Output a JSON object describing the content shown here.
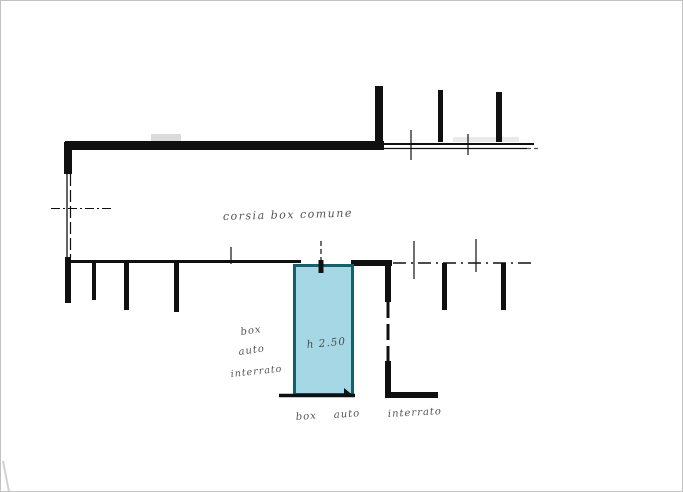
{
  "canvas": {
    "width": 683,
    "height": 492,
    "background": "#ffffff",
    "frame_color": "#c2c2c2"
  },
  "palette": {
    "ink": "#101010",
    "pencil": "#3b3b3b",
    "highlight_fill": "#a6d7e4",
    "highlight_stroke": "#175f6d",
    "smudge": "#b8b8b8",
    "page_edge": "#cccccc"
  },
  "annotations": {
    "lane_label": {
      "name": "lane-label",
      "text": "corsia box comune",
      "x": 222,
      "y": 219,
      "size": 11,
      "rotate": -1.5,
      "spacing": 1.5
    },
    "unit_label": {
      "name": "highlighted-unit-label",
      "text": "h 2.50",
      "x": 306,
      "y": 347,
      "size": 10.5,
      "rotate": -5
    },
    "side_note": {
      "lines": [
        {
          "name": "side-note-line-1",
          "text": "box",
          "x": 240,
          "y": 334,
          "size": 10,
          "rotate": -8
        },
        {
          "name": "side-note-line-2",
          "text": "auto",
          "x": 238,
          "y": 354,
          "size": 10,
          "rotate": -8
        },
        {
          "name": "side-note-line-3",
          "text": "interrato",
          "x": 230,
          "y": 376,
          "size": 9.5,
          "rotate": -6
        }
      ]
    },
    "bottom_note": {
      "words": [
        {
          "name": "bottom-note-word-1",
          "text": "box",
          "x": 295,
          "y": 419,
          "size": 10,
          "rotate": -4
        },
        {
          "name": "bottom-note-word-2",
          "text": "auto",
          "x": 333,
          "y": 417,
          "size": 10,
          "rotate": -4
        },
        {
          "name": "bottom-note-word-3",
          "text": "interrato",
          "x": 387,
          "y": 416,
          "size": 10,
          "rotate": -3
        }
      ]
    }
  },
  "drawing": {
    "elements": [
      {
        "k": "rect",
        "n": "scan-smudge",
        "x": 150,
        "y": 133,
        "w": 30,
        "h": 7,
        "fill": "smudge",
        "o": 0.5
      },
      {
        "k": "rect",
        "n": "scan-smudge",
        "x": 452,
        "y": 136,
        "w": 66,
        "h": 5,
        "fill": "smudge",
        "o": 0.3
      },
      {
        "k": "line",
        "n": "page-edge-mark",
        "x1": 2,
        "y1": 460,
        "x2": 8,
        "y2": 491,
        "stroke": "page_edge",
        "sw": 2,
        "o": 0.9
      },
      {
        "k": "rect",
        "n": "top-wall",
        "x": 64,
        "y": 140,
        "w": 319,
        "h": 9
      },
      {
        "k": "line",
        "n": "top-wall-extension-upper",
        "x1": 383,
        "y1": 143,
        "x2": 533,
        "y2": 143,
        "sw": 2
      },
      {
        "k": "line",
        "n": "top-wall-extension-lower",
        "x1": 383,
        "y1": 147.5,
        "x2": 526,
        "y2": 147.5,
        "sw": 1.2
      },
      {
        "k": "line",
        "n": "top-wall-extension-dash",
        "x1": 526,
        "y1": 147.5,
        "x2": 538,
        "y2": 147.5,
        "sw": 1.2,
        "dash": "4 3",
        "o": 0.7
      },
      {
        "k": "rect",
        "n": "upper-divider-tick",
        "x": 374,
        "y": 85,
        "w": 8,
        "h": 56
      },
      {
        "k": "rect",
        "n": "upper-divider-tick",
        "x": 437,
        "y": 89,
        "w": 5,
        "h": 52
      },
      {
        "k": "rect",
        "n": "upper-divider-tick",
        "x": 495,
        "y": 91,
        "w": 6,
        "h": 50
      },
      {
        "k": "line",
        "n": "survey-cross",
        "x1": 410,
        "y1": 129,
        "x2": 410,
        "y2": 159,
        "sw": 1.2
      },
      {
        "k": "line",
        "n": "survey-cross",
        "x1": 467,
        "y1": 133,
        "x2": 467,
        "y2": 154,
        "sw": 1.2
      },
      {
        "k": "rect",
        "n": "left-wall-corner",
        "x": 63,
        "y": 141,
        "w": 8,
        "h": 32
      },
      {
        "k": "line",
        "n": "left-wall-inner",
        "x1": 66,
        "y1": 173,
        "x2": 66,
        "y2": 259,
        "sw": 1.3
      },
      {
        "k": "line",
        "n": "left-wall-outer",
        "x1": 69.5,
        "y1": 173,
        "x2": 69.5,
        "y2": 257,
        "sw": 1.2,
        "dash": "12 4"
      },
      {
        "k": "rect",
        "n": "left-wall-lower",
        "x": 64,
        "y": 256,
        "w": 6,
        "h": 46
      },
      {
        "k": "line",
        "n": "centerline-cross",
        "x1": 50,
        "y1": 207.5,
        "x2": 110,
        "y2": 207.5,
        "sw": 1,
        "dash": "9 3 2 3"
      },
      {
        "k": "line",
        "n": "lower-wall-left",
        "x1": 64,
        "y1": 260.5,
        "x2": 300,
        "y2": 260.5,
        "sw": 3
      },
      {
        "k": "rect",
        "n": "lower-wall-mid",
        "x": 350,
        "y": 259,
        "w": 41,
        "h": 6
      },
      {
        "k": "line",
        "n": "lower-wall-dashdot",
        "x1": 392,
        "y1": 262,
        "x2": 533,
        "y2": 262,
        "sw": 1.5,
        "dash": "13 5 2 5"
      },
      {
        "k": "rect",
        "n": "lower-divider-tick",
        "x": 91,
        "y": 262,
        "w": 4,
        "h": 37
      },
      {
        "k": "rect",
        "n": "lower-divider-tick",
        "x": 123,
        "y": 262,
        "w": 5,
        "h": 47
      },
      {
        "k": "rect",
        "n": "lower-divider-tick",
        "x": 173,
        "y": 262,
        "w": 5,
        "h": 49
      },
      {
        "k": "rect",
        "n": "lower-divider-tick",
        "x": 441,
        "y": 262,
        "w": 5,
        "h": 47
      },
      {
        "k": "rect",
        "n": "lower-divider-tick",
        "x": 500,
        "y": 262,
        "w": 5,
        "h": 47
      },
      {
        "k": "line",
        "n": "survey-cross",
        "x1": 230,
        "y1": 246,
        "x2": 230,
        "y2": 263,
        "sw": 1.2
      },
      {
        "k": "line",
        "n": "survey-cross",
        "x1": 413,
        "y1": 240,
        "x2": 413,
        "y2": 278,
        "sw": 1.2
      },
      {
        "k": "line",
        "n": "survey-cross",
        "x1": 475,
        "y1": 238,
        "x2": 475,
        "y2": 271,
        "sw": 1.2
      },
      {
        "k": "rect",
        "n": "right-wall-upper",
        "x": 384,
        "y": 261,
        "w": 6,
        "h": 40
      },
      {
        "k": "line",
        "n": "right-wall-middle",
        "x1": 387,
        "y1": 301,
        "x2": 387,
        "y2": 362,
        "sw": 3,
        "dash": "16 6"
      },
      {
        "k": "rect",
        "n": "right-wall-lower",
        "x": 384,
        "y": 360,
        "w": 6,
        "h": 36
      },
      {
        "k": "rect",
        "n": "bottom-right-wall",
        "x": 384,
        "y": 391,
        "w": 53,
        "h": 6
      },
      {
        "k": "rect",
        "n": "highlighted-unit",
        "x": 293.5,
        "y": 264.5,
        "w": 58,
        "h": 129,
        "fill": "highlight_fill",
        "stroke": "highlight_stroke",
        "sw": 3
      },
      {
        "k": "line",
        "n": "survey-pin-line",
        "x1": 320,
        "y1": 240,
        "x2": 320,
        "y2": 259,
        "sw": 1.2,
        "dash": "5 3"
      },
      {
        "k": "rect",
        "n": "survey-pin-head",
        "x": 317.5,
        "y": 259,
        "w": 5,
        "h": 13
      },
      {
        "k": "line",
        "n": "unit-bottom-line",
        "x1": 278,
        "y1": 394.5,
        "x2": 354,
        "y2": 394.5,
        "sw": 3.5
      },
      {
        "k": "poly",
        "n": "unit-corner-arrow",
        "pts": "343,387 354,396 343,396"
      }
    ]
  }
}
